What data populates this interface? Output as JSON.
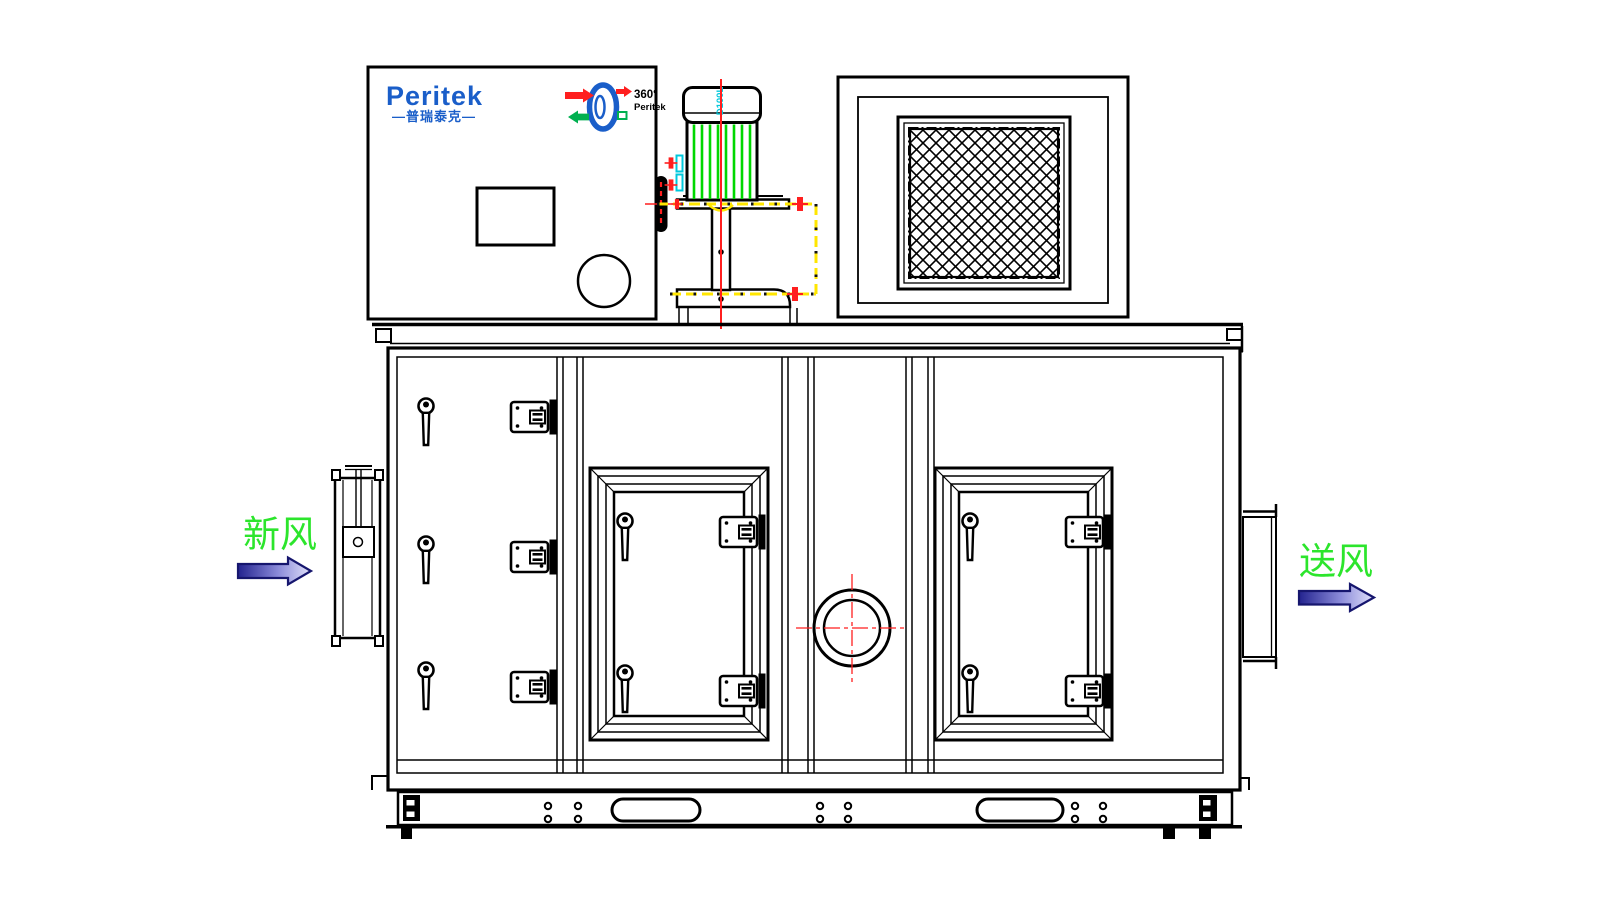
{
  "panel": {
    "brand": "Peritek",
    "brand_sub": "—普瑞泰克—"
  },
  "rotor_badge": {
    "degrees": "360°",
    "brand": "Peritek"
  },
  "motor": {
    "frame_label": "D100L"
  },
  "airflow": {
    "inlet": "新风",
    "outlet": "送风"
  },
  "colors": {
    "brand-blue": "#1a5ec9",
    "label-green": "#2ce52c",
    "fin-green": "#00d800",
    "centerline-red": "#ff1f1f",
    "datum-yellow": "#ffe600",
    "accent-cyan": "#00c8dc",
    "arrow-dark": "#23238f",
    "arrow-light": "#e2e2fa",
    "line-black": "#000000"
  }
}
